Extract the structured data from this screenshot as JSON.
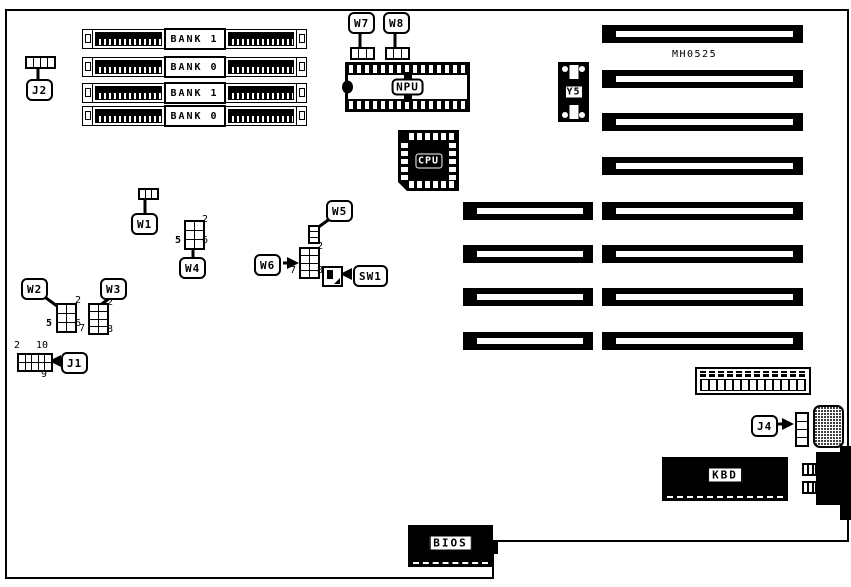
{
  "board": {
    "part_number": "MH0525",
    "background_color": "#ffffff",
    "line_color": "#000000"
  },
  "memory_banks": [
    {
      "label": "BANK 1"
    },
    {
      "label": "BANK 0"
    },
    {
      "label": "BANK 1"
    },
    {
      "label": "BANK 0"
    }
  ],
  "chips": {
    "npu": "NPU",
    "cpu": "CPU",
    "y5": "Y5",
    "bios": "BIOS",
    "kbd": "KBD"
  },
  "callouts": {
    "j1": "J1",
    "j2": "J2",
    "j4": "J4",
    "w1": "W1",
    "w2": "W2",
    "w3": "W3",
    "w4": "W4",
    "w5": "W5",
    "w6": "W6",
    "w7": "W7",
    "w8": "W8",
    "sw1": "SW1"
  },
  "pin_numbers": {
    "w2": {
      "top_right": "2",
      "bottom_left": "5",
      "bottom_right": "6"
    },
    "w3": {
      "top_right": "2",
      "bottom_left": "7",
      "bottom_right": "8"
    },
    "w4": {
      "top_right": "2",
      "bottom_left": "5",
      "bottom_right": "6"
    },
    "w6": {
      "top_right": "2",
      "bottom_left": "7",
      "bottom_right": "8"
    },
    "j1": {
      "top_left": "2",
      "top_right": "10",
      "bottom_right": "9"
    }
  }
}
